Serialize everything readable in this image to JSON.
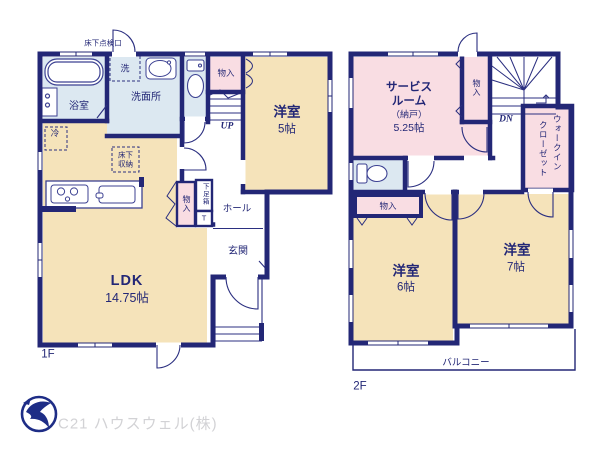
{
  "colors": {
    "wall_navy": "#232776",
    "line_navy": "#2b2f80",
    "room_cream": "#f5e3ba",
    "room_pink": "#f9dde3",
    "room_blue": "#dce8f1",
    "logo_navy": "#1e2d86",
    "watermark_gray": "#d2d2d5",
    "background": "#ffffff"
  },
  "f1": {
    "label": "1F",
    "ldk": "LDK",
    "ldk_size": "14.75帖",
    "yoshitsu": "洋室",
    "yoshitsu_size": "5帖",
    "bath": "浴室",
    "wash": "洗面所",
    "hall": "ホール",
    "genkan": "玄関",
    "up": "UP",
    "fridge": "冷",
    "washer": "洗",
    "floor_access": "床下点検口",
    "uf1": "床下",
    "uf2": "収納",
    "closet_top": "物入",
    "closet_mid": "物入",
    "shoebox": "下足箱",
    "shoebox_t": "T"
  },
  "f2": {
    "label": "2F",
    "sr1": "サービス",
    "sr2": "ルーム",
    "sr3": "（納戸）",
    "sr_size": "5.25帖",
    "closet_sr": "物入",
    "dn": "DN",
    "wic1": "ウォークイン",
    "wic2": "クローゼット",
    "closet6": "物入",
    "y6": "洋室",
    "y6_size": "6帖",
    "y7": "洋室",
    "y7_size": "7帖",
    "balcony": "バルコニー"
  },
  "footer": {
    "company": "C21 ハウスウェル(株)"
  }
}
